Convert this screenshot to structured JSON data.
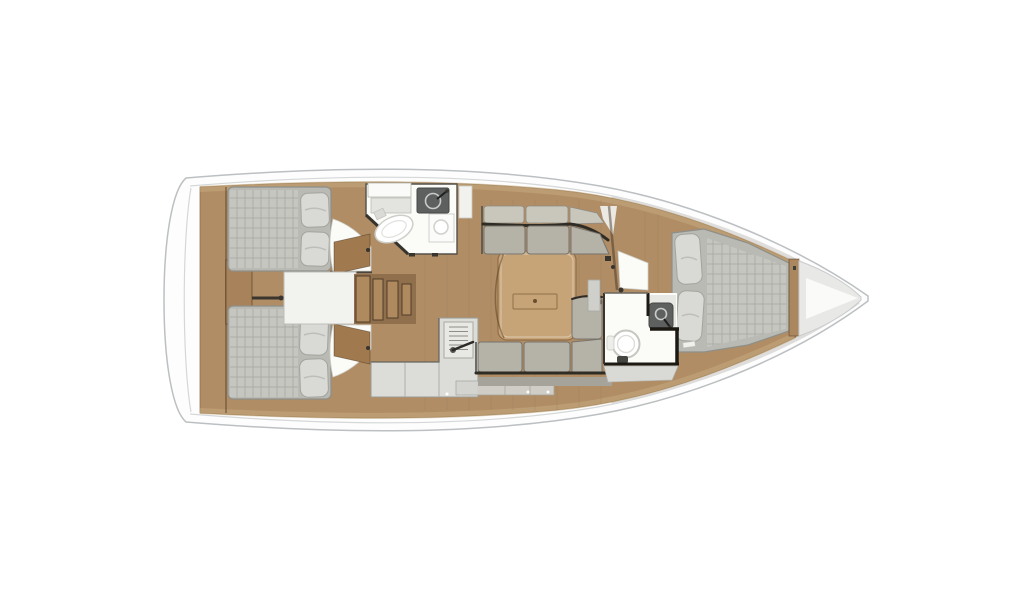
{
  "vessel": {
    "kind": "sailing-yacht-interior-floor-plan",
    "orientation": "bow-right",
    "description": "Top-down interior layout plan of a sailing yacht with two aft double cabins, central companionway steps, aft head with shower, L-shaped galley, saloon with facing settees and table, forward head and forward double-berth cabin, anchor locker in the bow",
    "cabins": 3,
    "heads": 2,
    "berth_count": 3
  },
  "rooms": [
    {
      "id": "aft-cabin-port",
      "name": "Aft double cabin (port)"
    },
    {
      "id": "aft-cabin-starboard",
      "name": "Aft double cabin (starboard)"
    },
    {
      "id": "companionway",
      "name": "Companionway steps"
    },
    {
      "id": "aft-head",
      "name": "Aft head with shower"
    },
    {
      "id": "galley",
      "name": "L-shaped galley with stove"
    },
    {
      "id": "salon",
      "name": "Saloon with settees and table"
    },
    {
      "id": "forward-head",
      "name": "Forward head"
    },
    {
      "id": "forward-cabin",
      "name": "Forward double-berth cabin"
    },
    {
      "id": "anchor-locker",
      "name": "Anchor locker"
    }
  ],
  "palette": {
    "hull_fill": "#fdfdfd",
    "hull_stroke": "#bcc0c2",
    "rail": "#d5d7d8",
    "flare": "#dedddb",
    "wood": "#b18d65",
    "wood_edge": "#8a6a48",
    "wood_light": "#c4a97e",
    "wood_dark": "#96744f",
    "step": "#b08a5f",
    "step_dark": "#4f3d29",
    "white_room": "#fbfbf8",
    "room_line": "#55504a",
    "wall": "#1c1913",
    "counter": "#dcdcd8",
    "counter_line": "#9a9a94",
    "dark_fix": "#5e605f",
    "metal": "#c9cac9",
    "mattress": "#b9bab4",
    "quilt": "#c5c6c0",
    "quilt_line": "#5a5a55",
    "pillow": "#d9dad6",
    "pillow_line": "#a3a49e",
    "cushion": "#b5b2a8",
    "backrest": "#c9c6bc",
    "seam": "#2f2b25",
    "table": "#c7a477",
    "gray_panel": "#d3d3cf",
    "locker": "#e8e8e6",
    "shower": "#e7e7e3",
    "door_wood": "#a0794f"
  }
}
